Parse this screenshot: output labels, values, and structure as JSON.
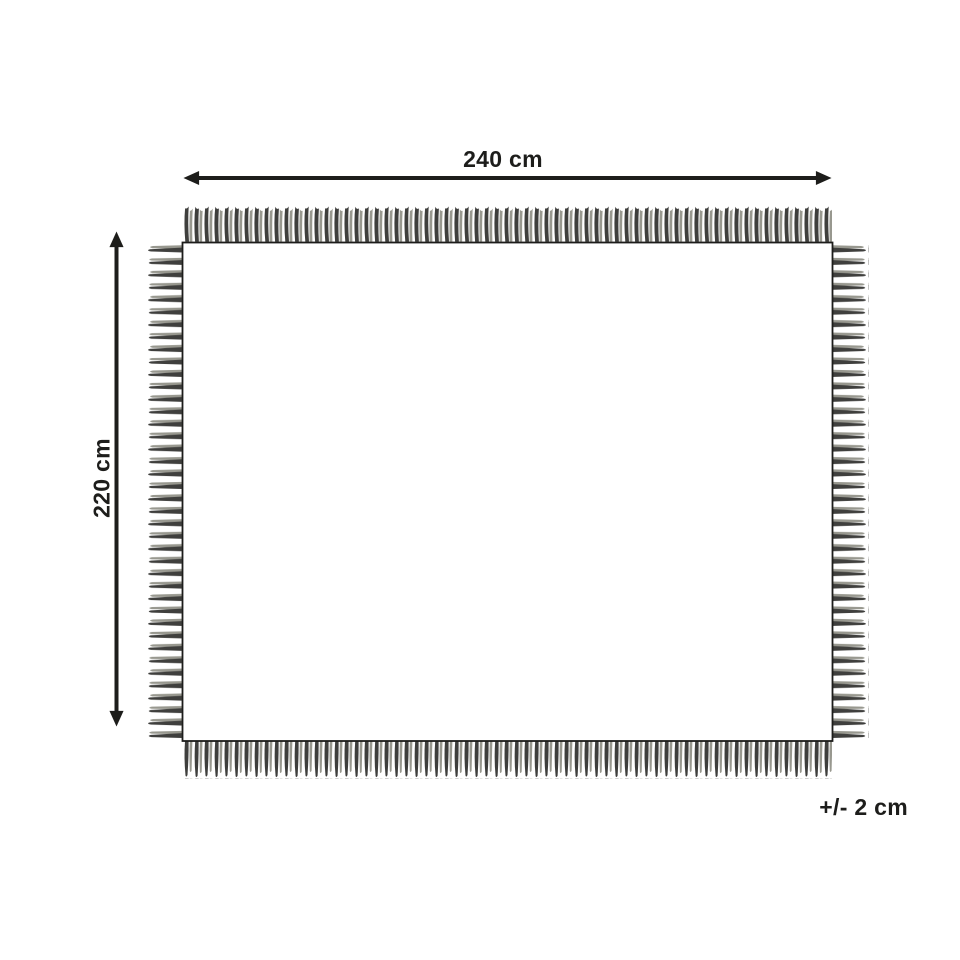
{
  "diagram": {
    "width_label": "240 cm",
    "height_label": "220 cm",
    "tolerance_label": "+/- 2 cm",
    "colors": {
      "line": "#1d1d1b",
      "fringe_dark": "#3f3f3d",
      "fringe_light": "#98988f",
      "background": "#ffffff"
    }
  }
}
